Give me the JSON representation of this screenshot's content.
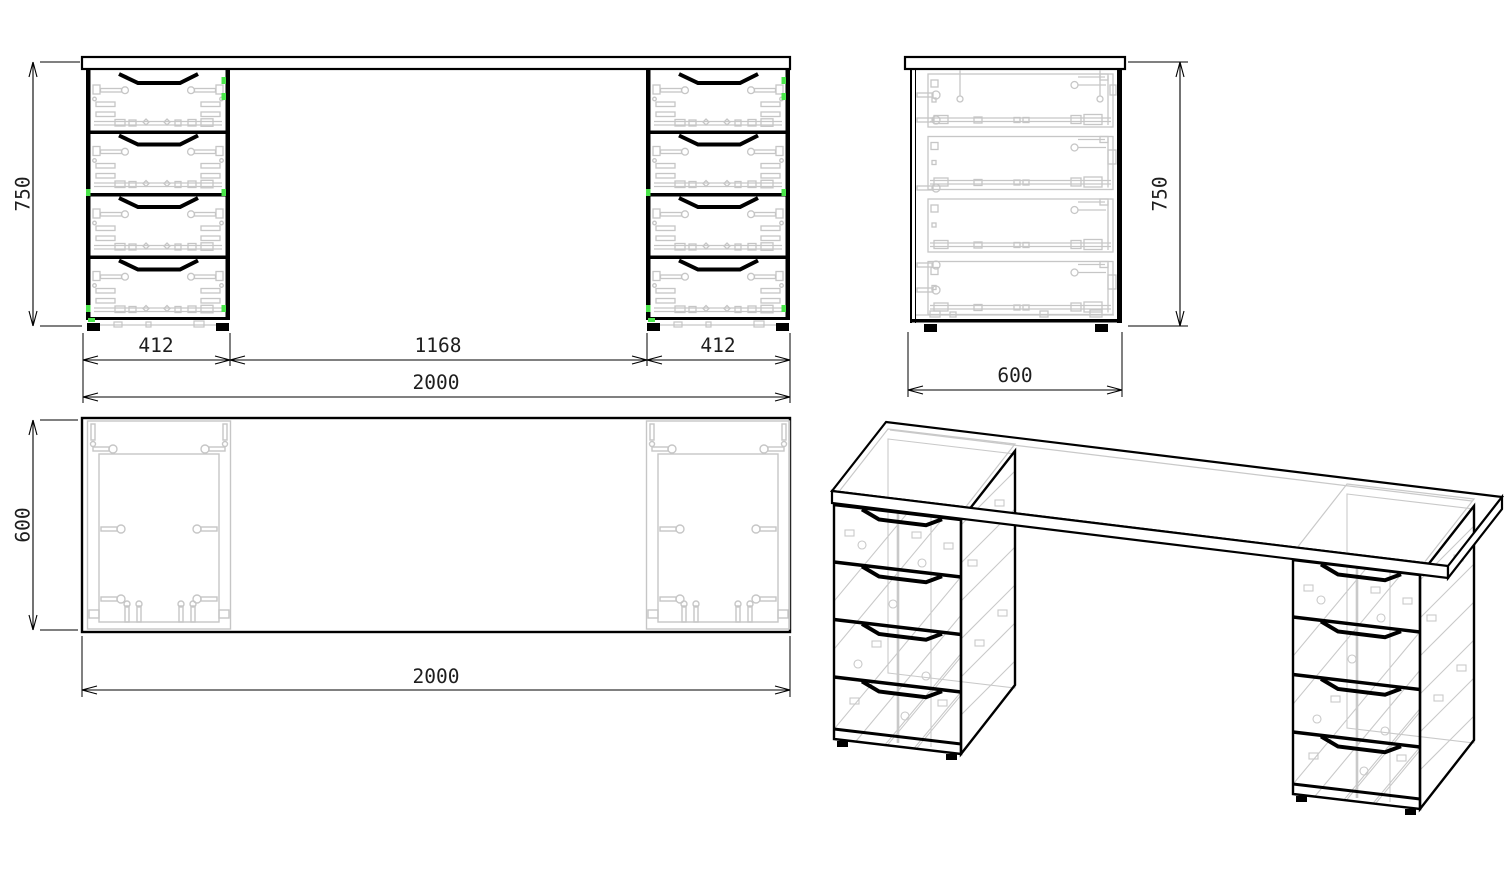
{
  "drawing": {
    "type": "furniture technical drawing - desk with two 4-drawer pedestals",
    "views": {
      "front": {
        "dims": {
          "pedestal_left": "412",
          "center_span": "1168",
          "pedestal_right": "412",
          "total_width": "2000",
          "height": "750"
        }
      },
      "side": {
        "dims": {
          "height": "750",
          "depth": "600"
        }
      },
      "top": {
        "dims": {
          "depth": "600",
          "width": "2000"
        }
      },
      "isometric": {}
    },
    "colors": {
      "outline": "#000000",
      "hidden_detail": "#c9c9c9",
      "fastener_highlight": "#4ce64c",
      "dim_text": "#1e1e1e",
      "background": "#ffffff"
    }
  }
}
